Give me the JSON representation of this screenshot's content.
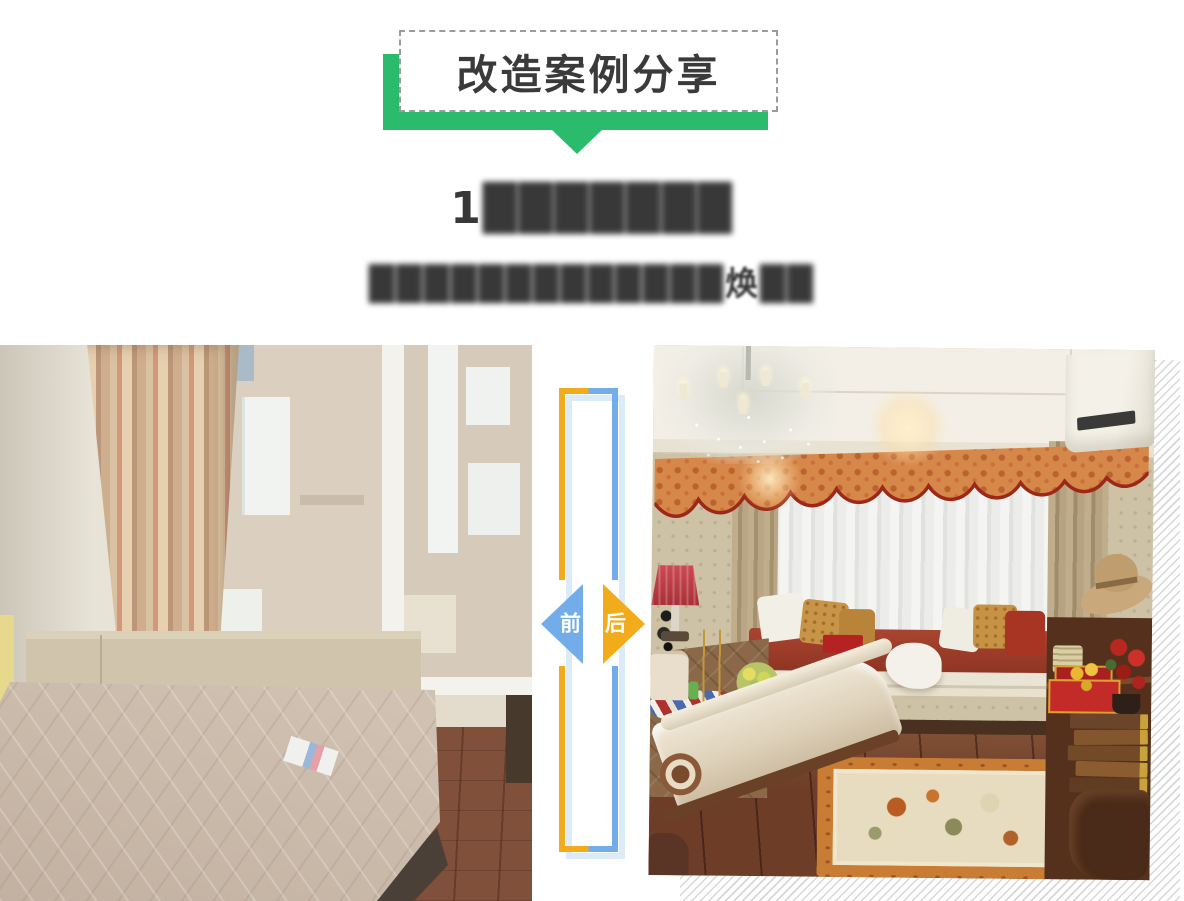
{
  "banner": {
    "title": "改造案例分享",
    "ribbon_color": "#2abb6d",
    "box_border_color": "#9b9b9b",
    "title_color": "#3a3a3a"
  },
  "headline": {
    "line1_prefix": "1",
    "line1_redacted": "███████",
    "line2_redacted_left": "█████████████",
    "line2_char": "焕",
    "line2_redacted_right": "██",
    "color": "#383838"
  },
  "divider": {
    "before_label": "前",
    "after_label": "后",
    "before_color": "#73ade9",
    "after_color": "#f2ab1b",
    "shadow_color": "#dcebf8"
  }
}
